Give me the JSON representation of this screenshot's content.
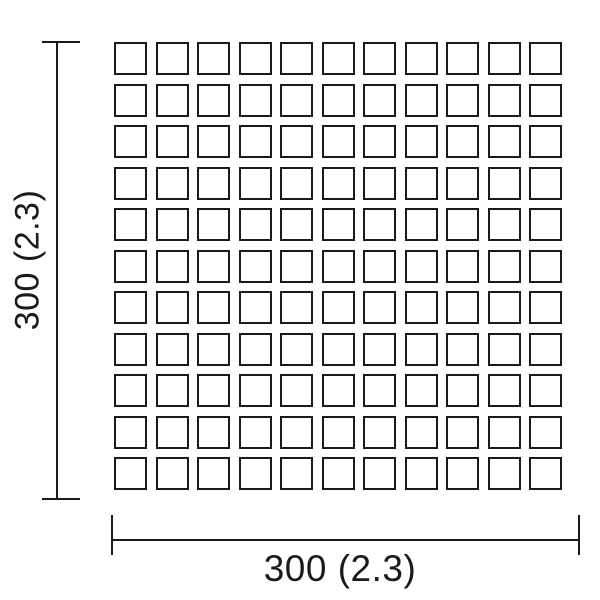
{
  "diagram": {
    "background_color": "#ffffff",
    "line_color": "#1a1a1a",
    "grid": {
      "rows": 11,
      "cols": 11
    },
    "dimensions": {
      "vertical": {
        "label": "300 (2.3)"
      },
      "horizontal": {
        "label": "300 (2.3)"
      }
    }
  }
}
